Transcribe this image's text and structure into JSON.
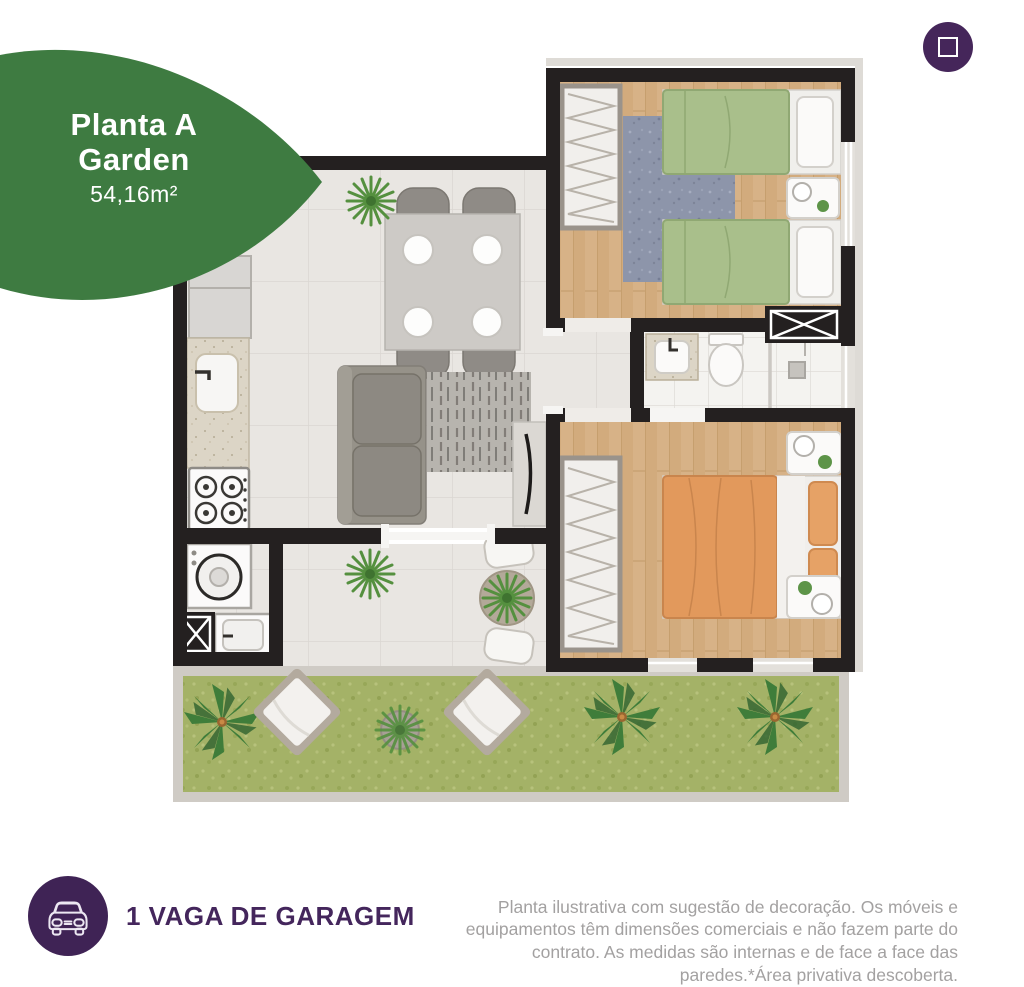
{
  "badge": {
    "title_line1": "Planta A",
    "title_line2": "Garden",
    "area": "54,16m²",
    "bg_color": "#3e7b41",
    "text_color": "#ffffff"
  },
  "controls": {
    "expand_button": {
      "icon": "fullscreen-icon",
      "bg_color": "#45265a"
    }
  },
  "floor_plan": {
    "rooms": [
      "bedroom-2",
      "bathroom",
      "hall",
      "bedroom-1",
      "living-dining",
      "kitchen",
      "laundry",
      "terrace",
      "garden"
    ],
    "palette": {
      "walls": "#242020",
      "wood_floor": "#d7b287",
      "tile_floor": "#e9e6e2",
      "bath_floor": "#f4f3f0",
      "grass": "#a4b267",
      "garden_curb": "#cfcbc5",
      "bed_green": "#a9bf8b",
      "bed_orange": "#e2995c",
      "rug_blue": "#8d95aa",
      "sofa_gray": "#969289"
    }
  },
  "footer": {
    "garage": {
      "icon": "car-icon",
      "label": "1 VAGA DE GARAGEM",
      "text_color": "#44265c",
      "icon_bg_color": "#3f2355"
    },
    "disclaimer": "Planta ilustrativa com sugestão de decoração. Os móveis e equipamentos têm dimensões comerciais e não fazem parte do contrato. As medidas são internas e de face a face das paredes.*Área privativa descoberta."
  }
}
